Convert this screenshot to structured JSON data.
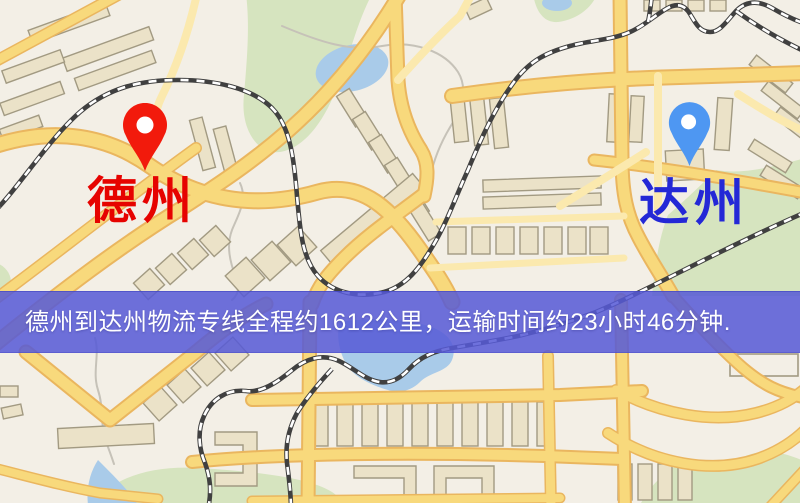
{
  "banner": {
    "text": "德州到达州物流专线全程约1612公里，运输时间约23小时46分钟.",
    "background": "rgba(86,90,214,0.86)",
    "text_color": "#ffffff"
  },
  "route": {
    "origin": "德州",
    "destination": "达州",
    "distance": "约1612公里",
    "duration": "约23小时46分钟"
  },
  "markers": {
    "origin": {
      "name": "德州",
      "pin_color": "#f21a0c",
      "label_color": "#e60300"
    },
    "destination": {
      "name": "达州",
      "pin_color": "#4e97f2",
      "label_color": "#2428d6"
    }
  },
  "map_palette": {
    "background": "#f3efe6",
    "green_area": "#d6e4bf",
    "water": "#a9cbe9",
    "road_major": "#f8d97c",
    "road_casing": "#eab65f",
    "road_minor": "#fbe9ae",
    "building_fill": "#ebe2c8",
    "building_stroke": "#a29a82",
    "railway_dark": "#404040",
    "railway_dash": "#ffffff",
    "path_gray": "#c6c2b8",
    "pin_hole": "#ffffff"
  }
}
